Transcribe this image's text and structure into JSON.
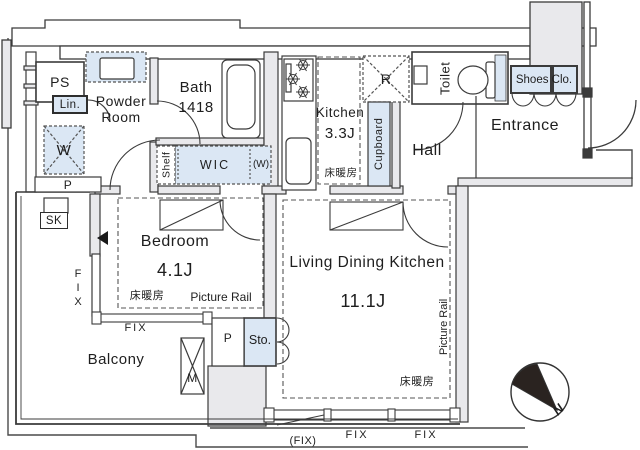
{
  "plan": {
    "rooms": {
      "ps": "PS",
      "powder_room": "Powder Room",
      "bath": "Bath",
      "bath_size": "1418",
      "kitchen": "Kitchen",
      "kitchen_size": "3.3J",
      "toilet": "Toilet",
      "entrance": "Entrance",
      "hall": "Hall",
      "bedroom": "Bedroom",
      "bedroom_size": "4.1J",
      "living_dining_kitchen": "Living Dining Kitchen",
      "ldk_size": "11.1J",
      "balcony": "Balcony",
      "wic": "WIC"
    },
    "features": {
      "linen": "Lin.",
      "washer": "W",
      "washer_alt": "(W)",
      "shelf": "Shelf",
      "cupboard": "Cupboard",
      "fridge": "R",
      "shoes_closet": "Shoes Clo.",
      "storage": "Sto.",
      "slop_sink": "SK",
      "meter_box": "M",
      "pipe_space": "P",
      "floor_heating": "床暖房",
      "picture_rail": "Picture Rail",
      "fix_window": "FIX",
      "fix_window_paren": "(FIX)",
      "compass_north": "N"
    },
    "colors": {
      "wall_fill": "#e9e9ec",
      "storage_fill": "#dbe7f4",
      "line": "#3b3b3b"
    }
  }
}
